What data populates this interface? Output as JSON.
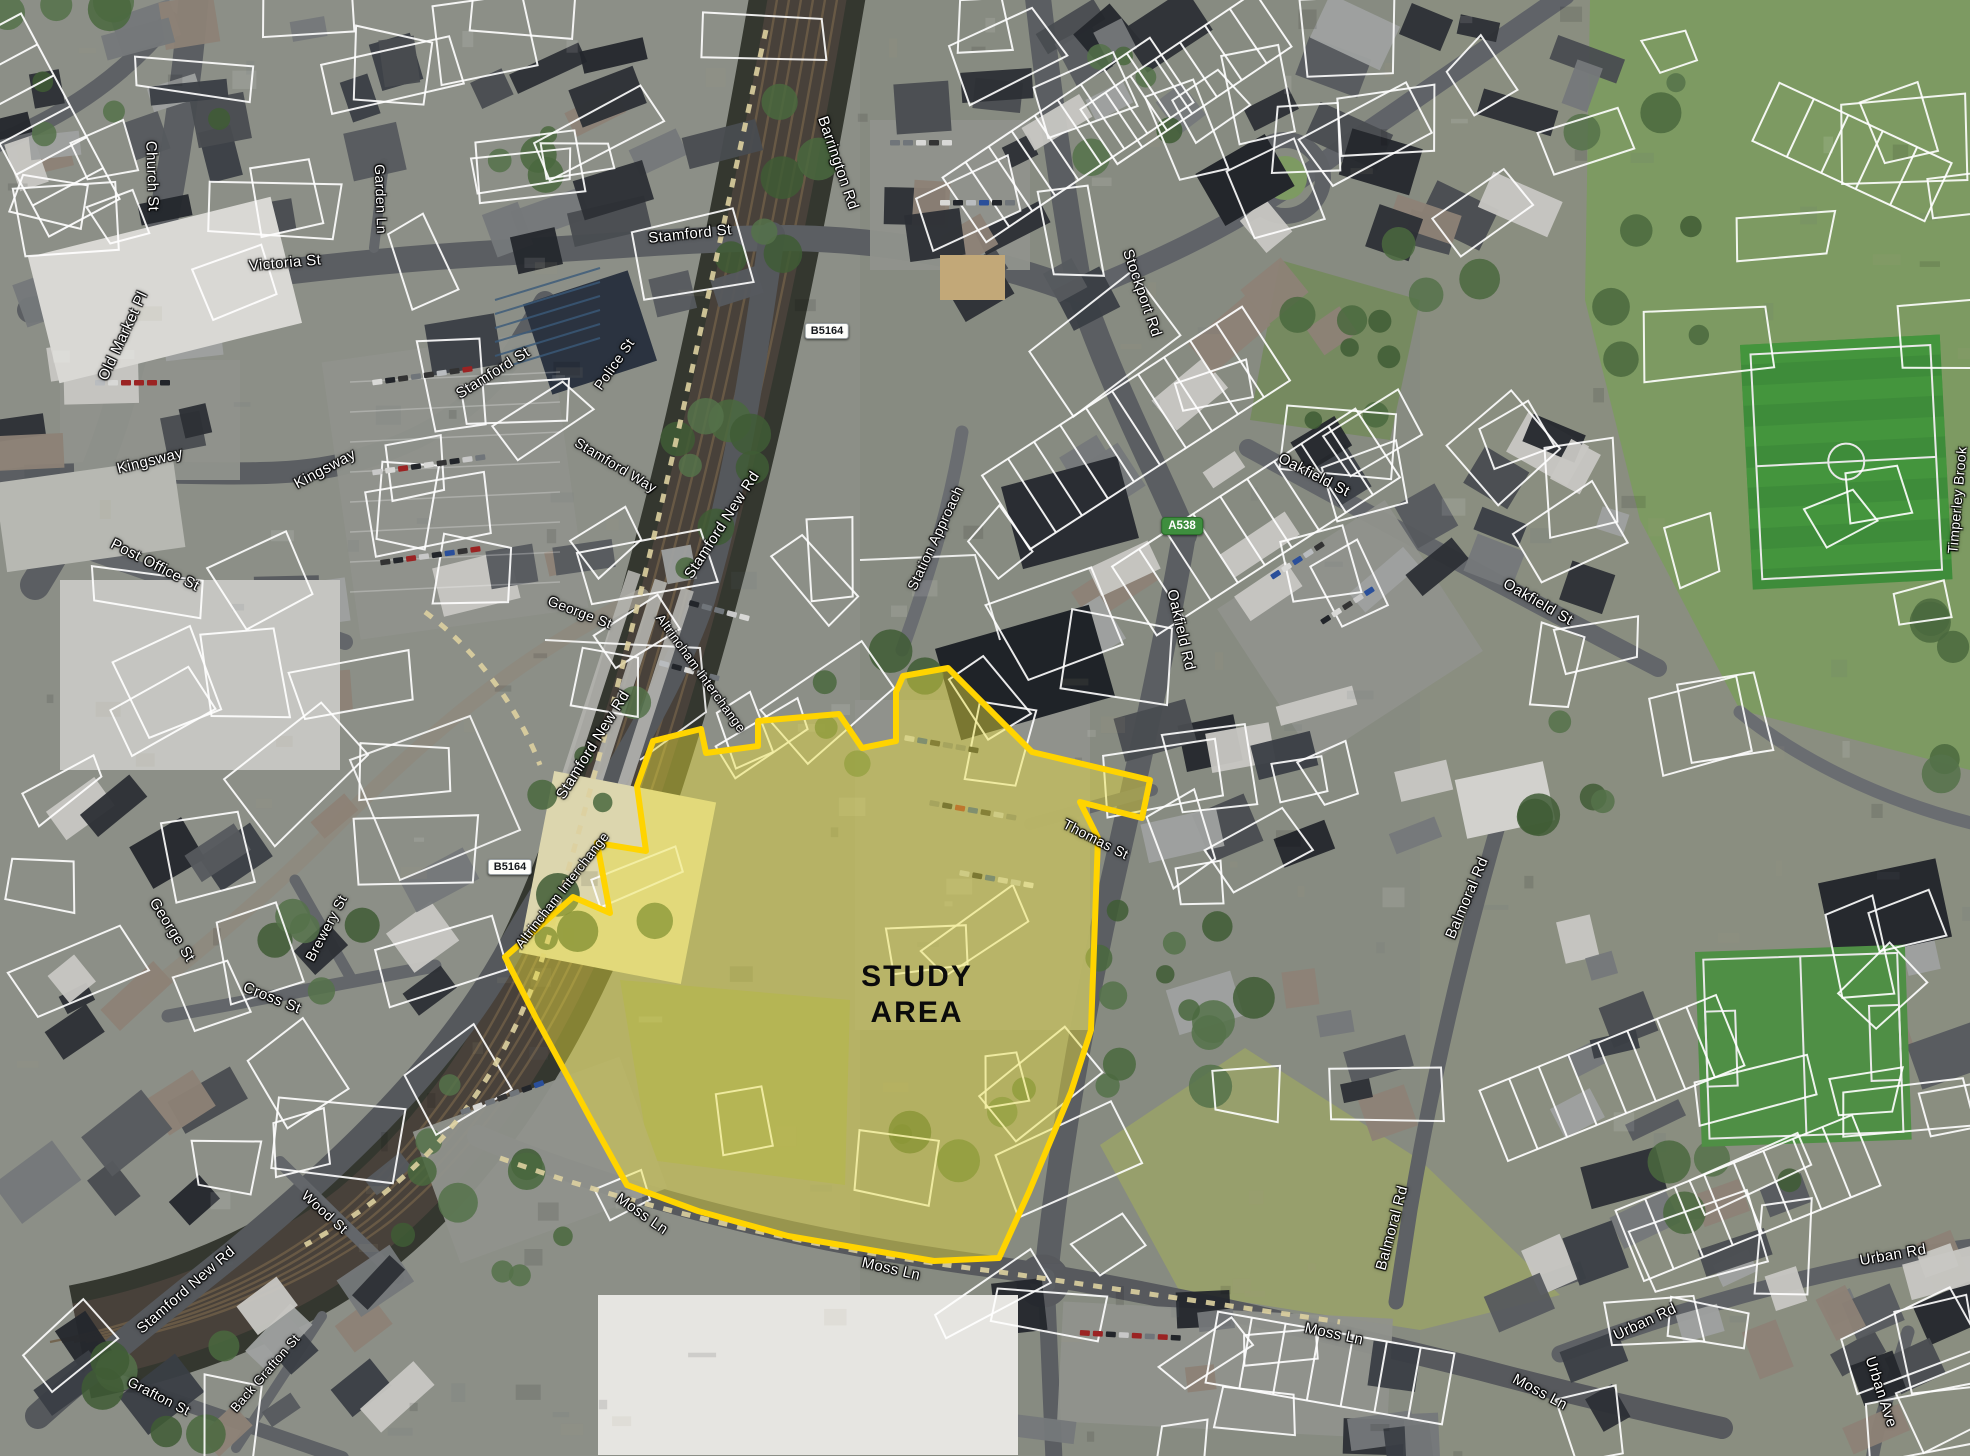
{
  "map": {
    "figure_type": "aerial-study-area-plan",
    "study_area": {
      "label_line1": "STUDY",
      "label_line2": "AREA",
      "label_x": 917,
      "label_y": 995,
      "fill_color": "#E8DE3C",
      "fill_opacity": 0.45,
      "outline_color": "#FFD400",
      "outline_width": 6,
      "polygon": [
        [
          903,
          676
        ],
        [
          948,
          668
        ],
        [
          1032,
          752
        ],
        [
          1150,
          780
        ],
        [
          1142,
          818
        ],
        [
          1080,
          802
        ],
        [
          1098,
          838
        ],
        [
          1091,
          1030
        ],
        [
          1071,
          1092
        ],
        [
          1029,
          1192
        ],
        [
          999,
          1258
        ],
        [
          934,
          1261
        ],
        [
          788,
          1236
        ],
        [
          698,
          1211
        ],
        [
          627,
          1185
        ],
        [
          590,
          1118
        ],
        [
          536,
          1018
        ],
        [
          505,
          957
        ],
        [
          573,
          897
        ],
        [
          610,
          913
        ],
        [
          597,
          843
        ],
        [
          646,
          851
        ],
        [
          637,
          786
        ],
        [
          653,
          741
        ],
        [
          701,
          729
        ],
        [
          706,
          753
        ],
        [
          758,
          746
        ],
        [
          758,
          721
        ],
        [
          839,
          714
        ],
        [
          862,
          748
        ],
        [
          896,
          741
        ],
        [
          896,
          692
        ]
      ]
    },
    "road_badges": [
      {
        "text": "B5164",
        "road_class": "B",
        "x": 827,
        "y": 331
      },
      {
        "text": "B5164",
        "road_class": "B",
        "x": 510,
        "y": 867
      },
      {
        "text": "A538",
        "road_class": "A",
        "x": 1182,
        "y": 526
      }
    ],
    "street_labels": [
      {
        "text": "Church St",
        "x": 152,
        "y": 176,
        "rot": 88,
        "size": 15
      },
      {
        "text": "Victoria St",
        "x": 285,
        "y": 263,
        "rot": -5,
        "size": 15
      },
      {
        "text": "Old Market Pl",
        "x": 123,
        "y": 336,
        "rot": -65,
        "size": 15
      },
      {
        "text": "Garden Ln",
        "x": 381,
        "y": 199,
        "rot": 88,
        "size": 14
      },
      {
        "text": "Kingsway",
        "x": 150,
        "y": 461,
        "rot": -14,
        "size": 15
      },
      {
        "text": "Kingsway",
        "x": 325,
        "y": 469,
        "rot": -28,
        "size": 15
      },
      {
        "text": "Post Office St",
        "x": 155,
        "y": 565,
        "rot": 27,
        "size": 15
      },
      {
        "text": "Stamford St",
        "x": 690,
        "y": 234,
        "rot": -6,
        "size": 15
      },
      {
        "text": "Stamford St",
        "x": 493,
        "y": 373,
        "rot": -32,
        "size": 15
      },
      {
        "text": "Police St",
        "x": 614,
        "y": 364,
        "rot": -55,
        "size": 14
      },
      {
        "text": "Stamford Way",
        "x": 616,
        "y": 465,
        "rot": 31,
        "size": 14
      },
      {
        "text": "Stamford New Rd",
        "x": 722,
        "y": 525,
        "rot": -57,
        "size": 15
      },
      {
        "text": "George St",
        "x": 580,
        "y": 612,
        "rot": 21,
        "size": 14
      },
      {
        "text": "Stamford New Rd",
        "x": 593,
        "y": 745,
        "rot": -58,
        "size": 15
      },
      {
        "text": "Altrincham Interchange",
        "x": 701,
        "y": 673,
        "rot": 54,
        "size": 13
      },
      {
        "text": "Altrincham Interchange",
        "x": 562,
        "y": 890,
        "rot": -52,
        "size": 13
      },
      {
        "text": "Station Approach",
        "x": 935,
        "y": 538,
        "rot": -65,
        "size": 14
      },
      {
        "text": "Barrington Rd",
        "x": 838,
        "y": 163,
        "rot": 71,
        "size": 15
      },
      {
        "text": "Stockport Rd",
        "x": 1142,
        "y": 293,
        "rot": 71,
        "size": 15
      },
      {
        "text": "Oakfield St",
        "x": 1314,
        "y": 475,
        "rot": 27,
        "size": 15
      },
      {
        "text": "Oakfield Rd",
        "x": 1181,
        "y": 630,
        "rot": 77,
        "size": 15
      },
      {
        "text": "Oakfield St",
        "x": 1538,
        "y": 602,
        "rot": 30,
        "size": 15
      },
      {
        "text": "Thomas St",
        "x": 1096,
        "y": 839,
        "rot": 27,
        "size": 14
      },
      {
        "text": "Balmoral Rd",
        "x": 1467,
        "y": 898,
        "rot": -67,
        "size": 15
      },
      {
        "text": "Balmoral Rd",
        "x": 1392,
        "y": 1228,
        "rot": -75,
        "size": 15
      },
      {
        "text": "Moss Ln",
        "x": 642,
        "y": 1214,
        "rot": 35,
        "size": 15
      },
      {
        "text": "Moss Ln",
        "x": 891,
        "y": 1269,
        "rot": 13,
        "size": 15
      },
      {
        "text": "Moss Ln",
        "x": 1334,
        "y": 1334,
        "rot": 12,
        "size": 15
      },
      {
        "text": "Moss Ln",
        "x": 1540,
        "y": 1392,
        "rot": 28,
        "size": 15
      },
      {
        "text": "Urban Rd",
        "x": 1893,
        "y": 1255,
        "rot": -10,
        "size": 15
      },
      {
        "text": "Urban Rd",
        "x": 1645,
        "y": 1322,
        "rot": -25,
        "size": 15
      },
      {
        "text": "Urban Ave",
        "x": 1881,
        "y": 1392,
        "rot": 72,
        "size": 15
      },
      {
        "text": "Wood St",
        "x": 325,
        "y": 1212,
        "rot": 42,
        "size": 14
      },
      {
        "text": "Cross St",
        "x": 272,
        "y": 998,
        "rot": 22,
        "size": 15
      },
      {
        "text": "Brewery St",
        "x": 326,
        "y": 928,
        "rot": -62,
        "size": 14
      },
      {
        "text": "George St",
        "x": 172,
        "y": 930,
        "rot": 58,
        "size": 15
      },
      {
        "text": "Grafton St",
        "x": 159,
        "y": 1396,
        "rot": 27,
        "size": 14
      },
      {
        "text": "Back Grafton St",
        "x": 265,
        "y": 1373,
        "rot": -49,
        "size": 13
      },
      {
        "text": "Stamford New Rd",
        "x": 186,
        "y": 1290,
        "rot": -41,
        "size": 15
      },
      {
        "text": "Timperley Brook",
        "x": 1957,
        "y": 500,
        "rot": -85,
        "size": 14
      }
    ],
    "colors": {
      "badge_a_bg": "#3E8E3E",
      "badge_a_text": "#FFFFFF",
      "badge_b_bg": "#FDFDFA",
      "badge_b_text": "#15181C",
      "street_label_text": "#FFFFFF",
      "street_label_halo": "#000000",
      "study_label_text": "#0B0B0B",
      "parcel_line": "#FFFFFF"
    }
  }
}
